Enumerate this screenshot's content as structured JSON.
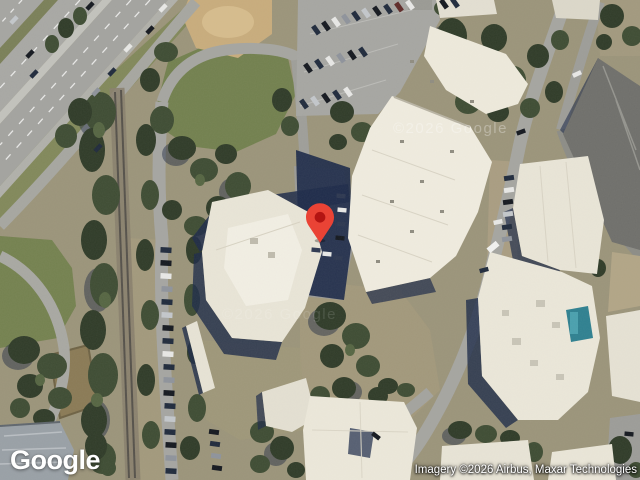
{
  "ui": {
    "logo_text": "Google",
    "attribution_text": "Imagery ©2026 Airbus, Maxar Technologies",
    "watermark_text": "©2026 Google",
    "watermark_secondary_text": "©2026 Google"
  },
  "marker": {
    "body_color": "#EA4335",
    "dot_color": "#B31412"
  },
  "palette": {
    "roof_cream": "#ece8da",
    "vegetation_dark": "#2f3b28",
    "grass": "#74814f",
    "dirt": "#c8ac7c",
    "asphalt": "#a5a5a0",
    "shadow_navy": "#1d2a49",
    "pool_teal": "#2e8090",
    "gray_roof": "#6f6f6b"
  }
}
